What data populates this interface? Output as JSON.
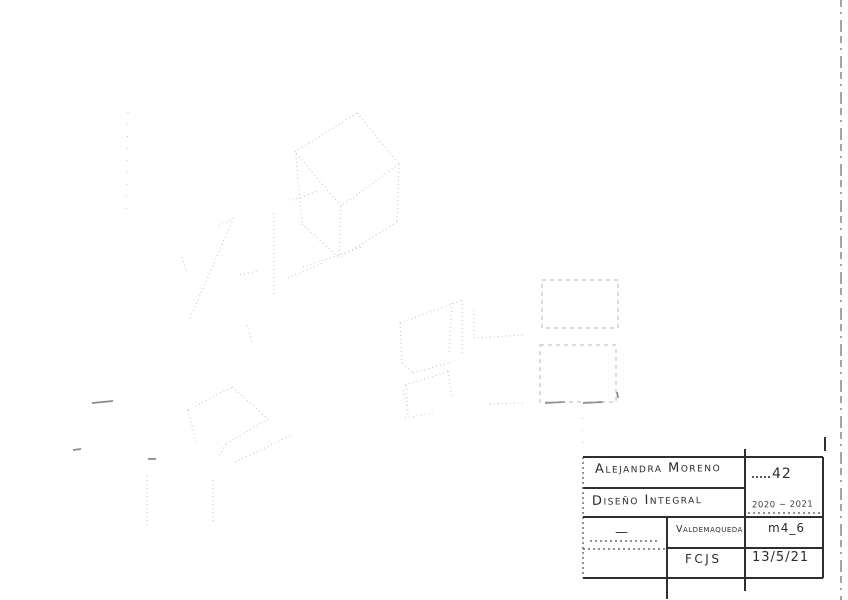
{
  "title_block": {
    "author": "Alejandra Moreno",
    "course": "Diseño Integral",
    "sheet_number": "42",
    "period": "2020 ~ 2021",
    "left_note": "—",
    "location": "Valdemaqueda",
    "module": "m4_6",
    "code": "FCJS",
    "date": "13/5/21"
  },
  "drawing": {
    "pencil_color": "#b6b6b6",
    "ink_color": "#2e2e2e",
    "pencil": [
      [
        295,
        152,
        357,
        113
      ],
      [
        357,
        113,
        399,
        164
      ],
      [
        399,
        164,
        341,
        206
      ],
      [
        341,
        206,
        295,
        152
      ],
      [
        296,
        154,
        302,
        224
      ],
      [
        341,
        206,
        339,
        258
      ],
      [
        399,
        164,
        397,
        222
      ],
      [
        302,
        224,
        339,
        258
      ],
      [
        397,
        222,
        339,
        258
      ],
      [
        303,
        267,
        362,
        247
      ],
      [
        219,
        226,
        236,
        217
      ],
      [
        232,
        222,
        190,
        318
      ],
      [
        274,
        213,
        274,
        296
      ],
      [
        240,
        275,
        258,
        271
      ],
      [
        288,
        278,
        325,
        262
      ],
      [
        293,
        200,
        318,
        191
      ],
      [
        182,
        257,
        186,
        271
      ],
      [
        247,
        325,
        252,
        342
      ],
      [
        400,
        323,
        463,
        300
      ],
      [
        462,
        300,
        462,
        353
      ],
      [
        400,
        323,
        402,
        363
      ],
      [
        402,
        363,
        413,
        373
      ],
      [
        413,
        373,
        452,
        362
      ],
      [
        452,
        303,
        449,
        355
      ],
      [
        405,
        385,
        450,
        371
      ],
      [
        406,
        385,
        408,
        414
      ],
      [
        448,
        371,
        452,
        399
      ],
      [
        405,
        418,
        433,
        413
      ],
      [
        474,
        310,
        474,
        338
      ],
      [
        474,
        338,
        524,
        335
      ],
      [
        188,
        410,
        232,
        387
      ],
      [
        232,
        387,
        268,
        419
      ],
      [
        188,
        410,
        196,
        442
      ],
      [
        268,
        419,
        226,
        444
      ],
      [
        226,
        444,
        218,
        458
      ],
      [
        235,
        462,
        290,
        436
      ],
      [
        147,
        476,
        147,
        528
      ],
      [
        213,
        480,
        213,
        523
      ],
      [
        490,
        404,
        523,
        403
      ],
      [
        403,
        390,
        405,
        402
      ]
    ],
    "pencil_sparse": [
      [
        128,
        112,
        126,
        218
      ],
      [
        582,
        418,
        583,
        452
      ]
    ],
    "dashed_boxes": [
      {
        "x": 542,
        "y": 280,
        "w": 76,
        "h": 48
      },
      {
        "x": 540,
        "y": 345,
        "w": 76,
        "h": 57
      }
    ],
    "dark_marks": [
      [
        92,
        403,
        113,
        401
      ],
      [
        73,
        450,
        81,
        449
      ],
      [
        148,
        459,
        156,
        459
      ],
      [
        545,
        403,
        565,
        402
      ],
      [
        583,
        403,
        603,
        402
      ],
      [
        617,
        392,
        618,
        398
      ]
    ],
    "page_edge": [
      841,
      0,
      841,
      600
    ]
  },
  "table": {
    "solid": [
      [
        583,
        457,
        823,
        457
      ],
      [
        583,
        578,
        823,
        578
      ],
      [
        823,
        457,
        823,
        578
      ],
      [
        745,
        449,
        745,
        591
      ],
      [
        667,
        517,
        667,
        599
      ],
      [
        583,
        488,
        745,
        488
      ],
      [
        583,
        517,
        823,
        517
      ],
      [
        667,
        548,
        823,
        548
      ],
      [
        825,
        437,
        825,
        451
      ]
    ],
    "dotted": [
      [
        583,
        457,
        583,
        578
      ],
      [
        748,
        513,
        820,
        513
      ],
      [
        590,
        541,
        660,
        541
      ],
      [
        583,
        549,
        667,
        549
      ]
    ]
  }
}
